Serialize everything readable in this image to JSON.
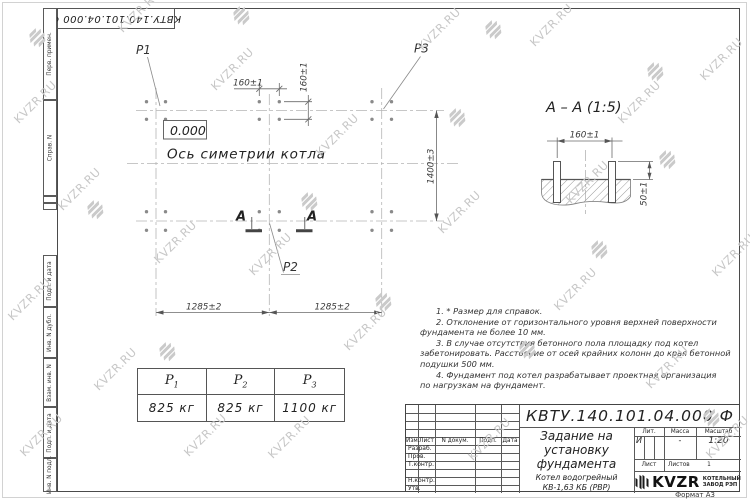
{
  "watermark": {
    "text": "KVZR.RU"
  },
  "frame": {
    "top_designation": "КВТУ.140.101.04.000  Ф",
    "strip": [
      "Перв. примен.",
      "Справ. N",
      "Подп. и дата",
      "Инв. N дубл.",
      "Взам. инв. N",
      "Подп. и дата",
      "Инв. N подл."
    ]
  },
  "plan": {
    "p1": "P1",
    "p2": "P2",
    "p3": "P3",
    "elevation": "0.000",
    "axis_label": "Ось симетрии котла",
    "section_letter": "А",
    "dim_160_h": "160±1",
    "dim_160_v": "160±1",
    "dim_1400": "1400±3",
    "dim_1285_l": "1285±2",
    "dim_1285_r": "1285±2"
  },
  "section_view": {
    "title": "А – А (1:5)",
    "dim_160": "160±1",
    "dim_50": "50±1"
  },
  "notes": {
    "lines": [
      "1. * Размер для справок.",
      "2. Отклонение от горизонтального уровня верхней поверхности",
      "фундамента не более 10 мм.",
      "3. В случае отсутствия бетонного пола площадку под котел",
      "забетонировать. Расстояние от осей крайних колонн до края бетонной",
      "подушки 500 мм.",
      "4. Фундамент под котел разрабатывает проектная организация",
      "по нагрузкам на фундамент."
    ]
  },
  "load_table": {
    "p": "P",
    "subs": [
      "1",
      "2",
      "3"
    ],
    "values": [
      "825 кг",
      "825 кг",
      "1100 кг"
    ]
  },
  "title_block": {
    "designation": "КВТУ.140.101.04.000  Ф",
    "title_lines": [
      "Задание на",
      "установку",
      "фундамента"
    ],
    "product_lines": [
      "Котел водогрейный",
      "КВ-1,63 КБ (РВР)"
    ],
    "col_izm": "Изм.",
    "col_list": "Лист",
    "col_ndoc": "N докум.",
    "col_podp": "Подп.",
    "col_data": "Дата",
    "rows": [
      "Разраб.",
      "Пров.",
      "Т.контр.",
      "Н.контр.",
      "Утв."
    ],
    "lit_label": "Лит.",
    "mass_label": "Масса",
    "scale_label": "Масштаб",
    "lit_value": "И",
    "mass_value": "-",
    "scale_value": "1:20",
    "sheet_label": "Лист",
    "sheets_label": "Листов",
    "sheets_value": "1",
    "logo_text": "KVZR",
    "logo_caption_1": "КОТЕЛЬНЫЙ",
    "logo_caption_2": "ЗАВОД РЭП",
    "format_label": "Формат А3"
  }
}
